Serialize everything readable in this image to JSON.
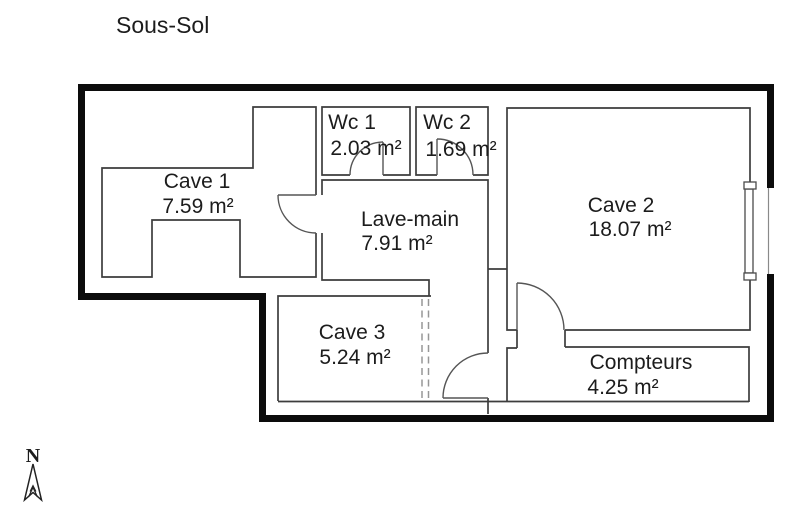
{
  "page_title": "Sous-Sol",
  "rooms": {
    "cave1": {
      "name": "Cave 1",
      "area": "7.59 m²"
    },
    "wc1": {
      "name": "Wc 1",
      "area": "2.03 m²"
    },
    "wc2": {
      "name": "Wc 2",
      "area": "1.69 m²"
    },
    "lave_main": {
      "name": "Lave-main",
      "area": "7.91 m²"
    },
    "cave2": {
      "name": "Cave 2",
      "area": "18.07 m²"
    },
    "cave3": {
      "name": "Cave 3",
      "area": "5.24 m²"
    },
    "compteurs": {
      "name": "Compteurs",
      "area": "4.25 m²"
    }
  },
  "compass": {
    "north_label": "N"
  },
  "colors": {
    "wall": "#0c0c0c",
    "line": "#3d3d3d",
    "background": "#ffffff",
    "text": "#1c1c1c"
  }
}
